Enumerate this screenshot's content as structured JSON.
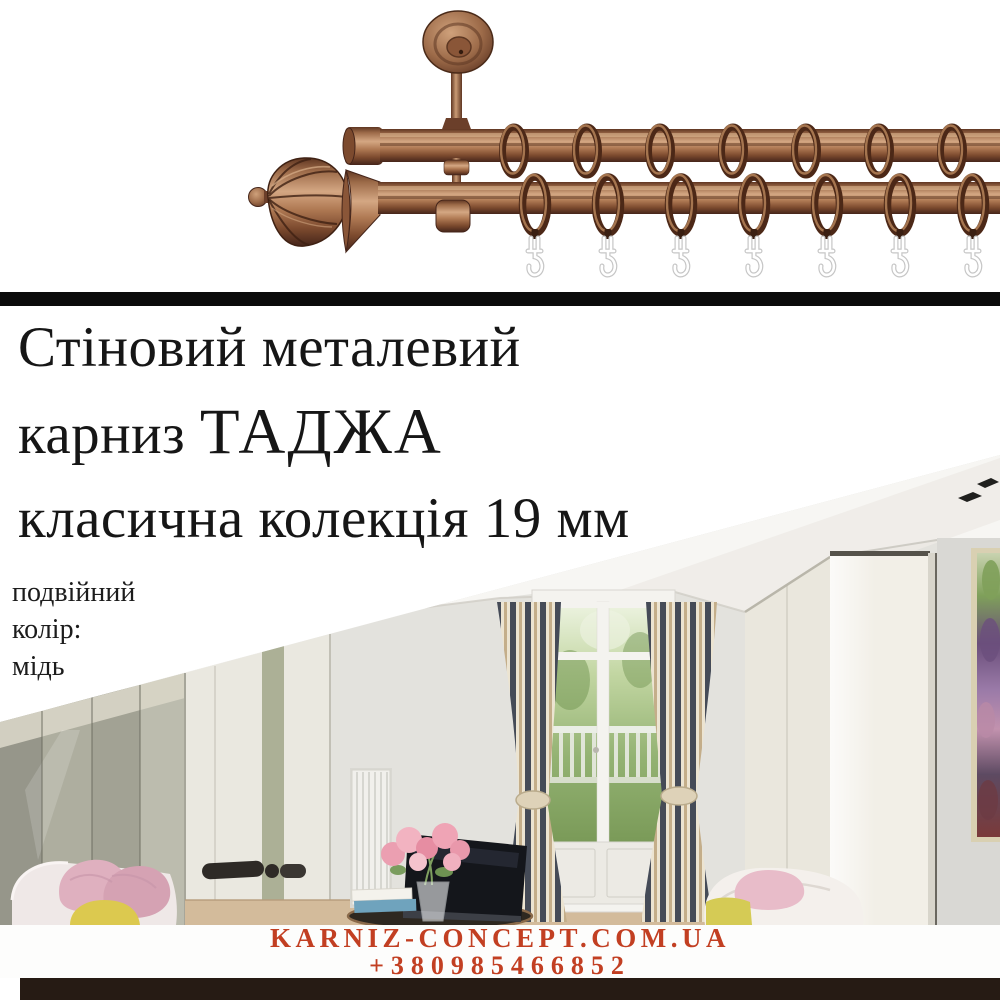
{
  "title": {
    "line1": "Стіновий металевий",
    "line2_prefix": "карниз ",
    "line2_name": "ТАДЖА",
    "line3": "класична колекція 19 мм"
  },
  "specs": {
    "type_value": "подвійний",
    "color_label": "колір:",
    "color_value": "мідь"
  },
  "footer": {
    "website": "KARNIZ-CONCEPT.COM.UA",
    "phone": "+380985466852"
  },
  "colors": {
    "accent_red": "#c23f22",
    "divider_bar": "#0b0b0b",
    "bottom_bar": "#261b14",
    "copper_mid": "#9d6b49",
    "copper_dark": "#4c2817",
    "copper_light": "#d4a783",
    "title_text": "#161616"
  }
}
